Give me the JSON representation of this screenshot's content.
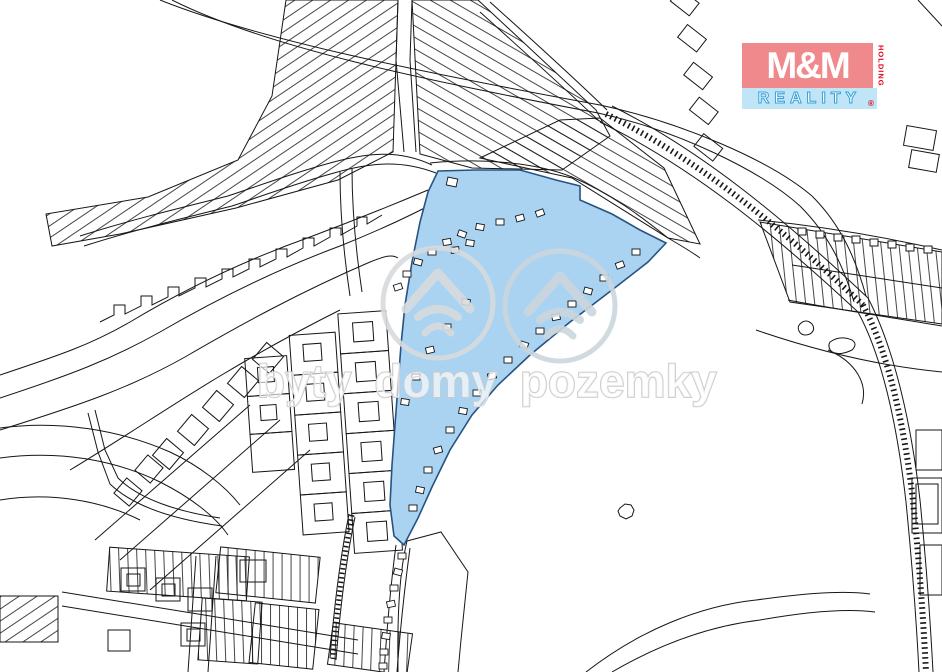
{
  "map": {
    "description": "cadastral parcel map with highlighted listing parcel",
    "highlighted_parcel_name": "highlighted-parcel"
  },
  "watermark": {
    "text": "byty domy pozemky",
    "color": "#c9c9c9",
    "fill": "rgba(255,255,255,0.65)",
    "circle_color": "#d7dbde"
  },
  "logo": {
    "mm": "M&M",
    "holding": "HOLDING",
    "reality": "REALITY",
    "registered": "®",
    "pink_bg": "#f0898c",
    "blue_bg": "#bfe5f7",
    "red": "#e2001a"
  },
  "colors": {
    "background": "#ffffff",
    "line": "#161616",
    "parcel_highlight": "#aad3f2",
    "parcel_highlight_border": "#265381"
  }
}
